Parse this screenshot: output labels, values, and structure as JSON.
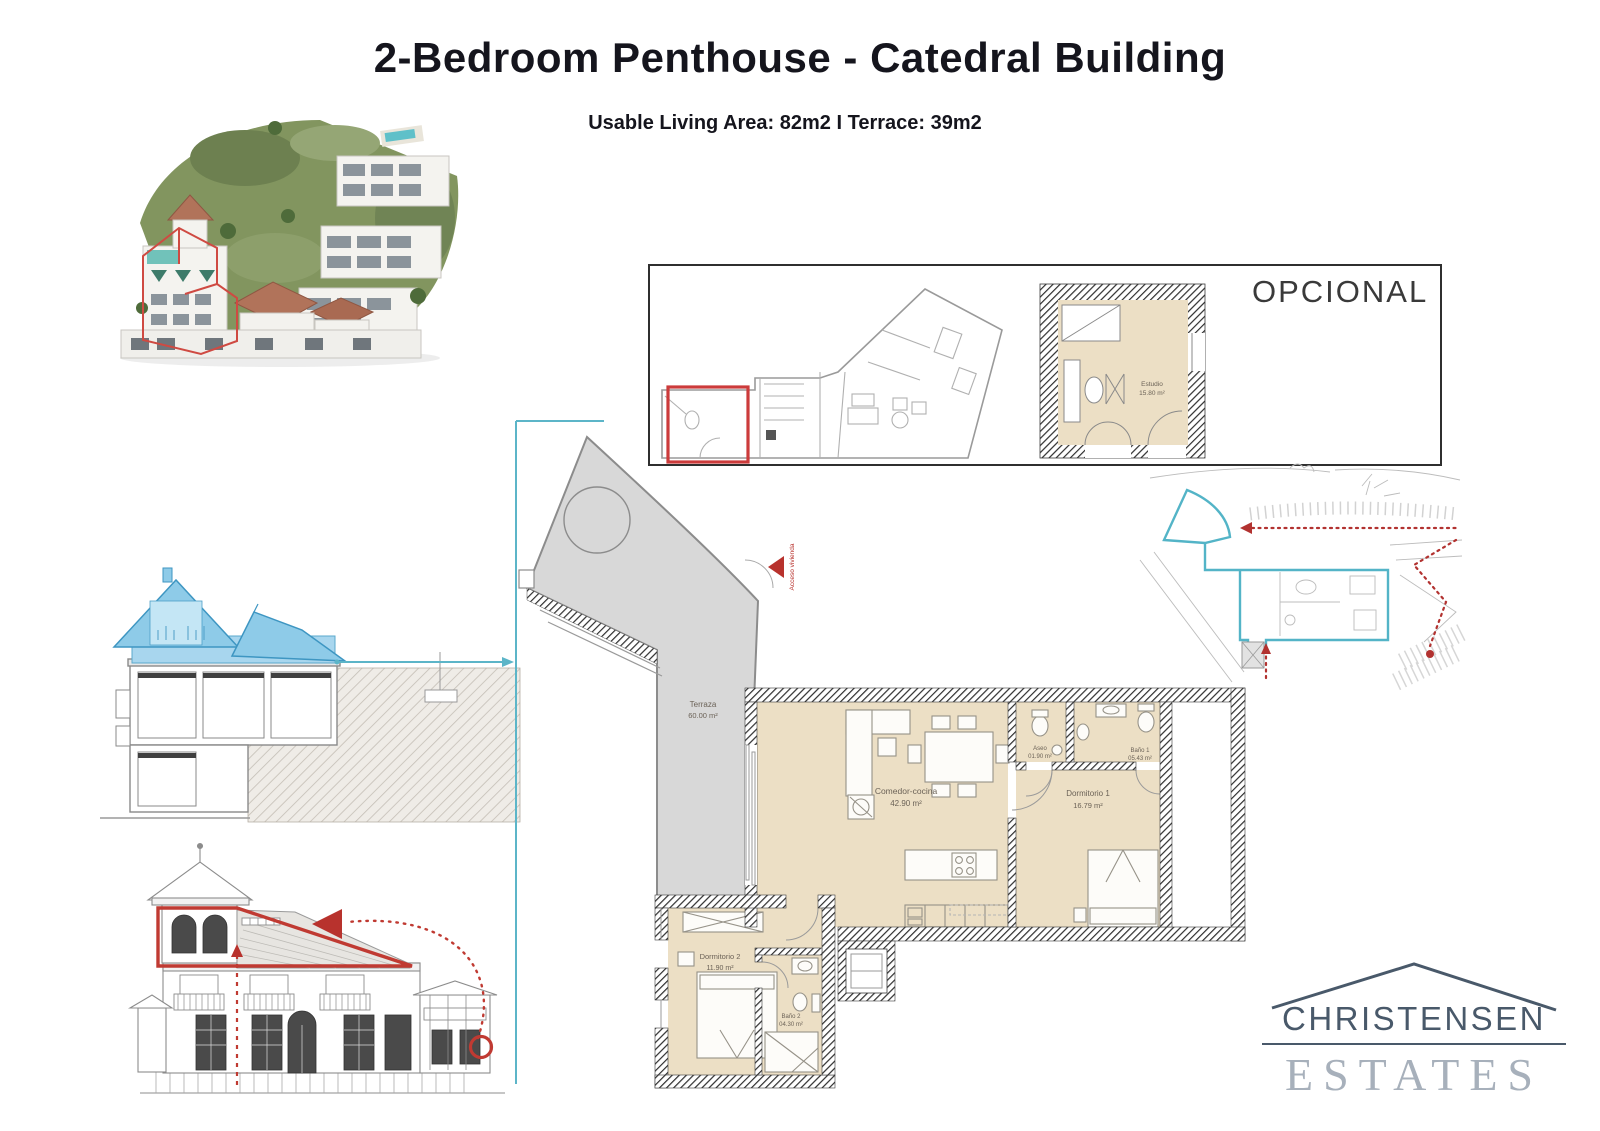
{
  "page": {
    "title": "2-Bedroom Penthouse - Catedral Building",
    "subtitle": "Usable Living Area: 82m2 I Terrace: 39m2"
  },
  "optional_panel": {
    "label": "OPCIONAL",
    "room": {
      "name": "Estudio",
      "area": "15.80 m²"
    }
  },
  "floor_plan": {
    "entry_label": "Acceso vivienda",
    "rooms": [
      {
        "name": "Terraza",
        "area": "60.00 m²"
      },
      {
        "name": "Comedor-cocina",
        "area": "42.90 m²"
      },
      {
        "name": "Aseo",
        "area": "01.90 m²"
      },
      {
        "name": "Baño 1",
        "area": "05.43 m²"
      },
      {
        "name": "Dormitorio 1",
        "area": "16.79 m²"
      },
      {
        "name": "Dormitorio 2",
        "area": "11.90 m²"
      },
      {
        "name": "Baño 2",
        "area": "04.30 m²"
      }
    ]
  },
  "logo": {
    "line1": "CHRISTENSEN",
    "line2": "ESTATES"
  },
  "colors": {
    "accent_teal": "#5cb5c8",
    "accent_red": "#c23b36",
    "section_highlight_blue": "#8ecbe8",
    "plan_floor_beige": "#ecdfc5",
    "plan_terrace_grey": "#d8d8d8",
    "plan_wall_dark": "#2e2e2e",
    "logo_dark": "#49596a",
    "logo_light": "#a7b0bb"
  }
}
